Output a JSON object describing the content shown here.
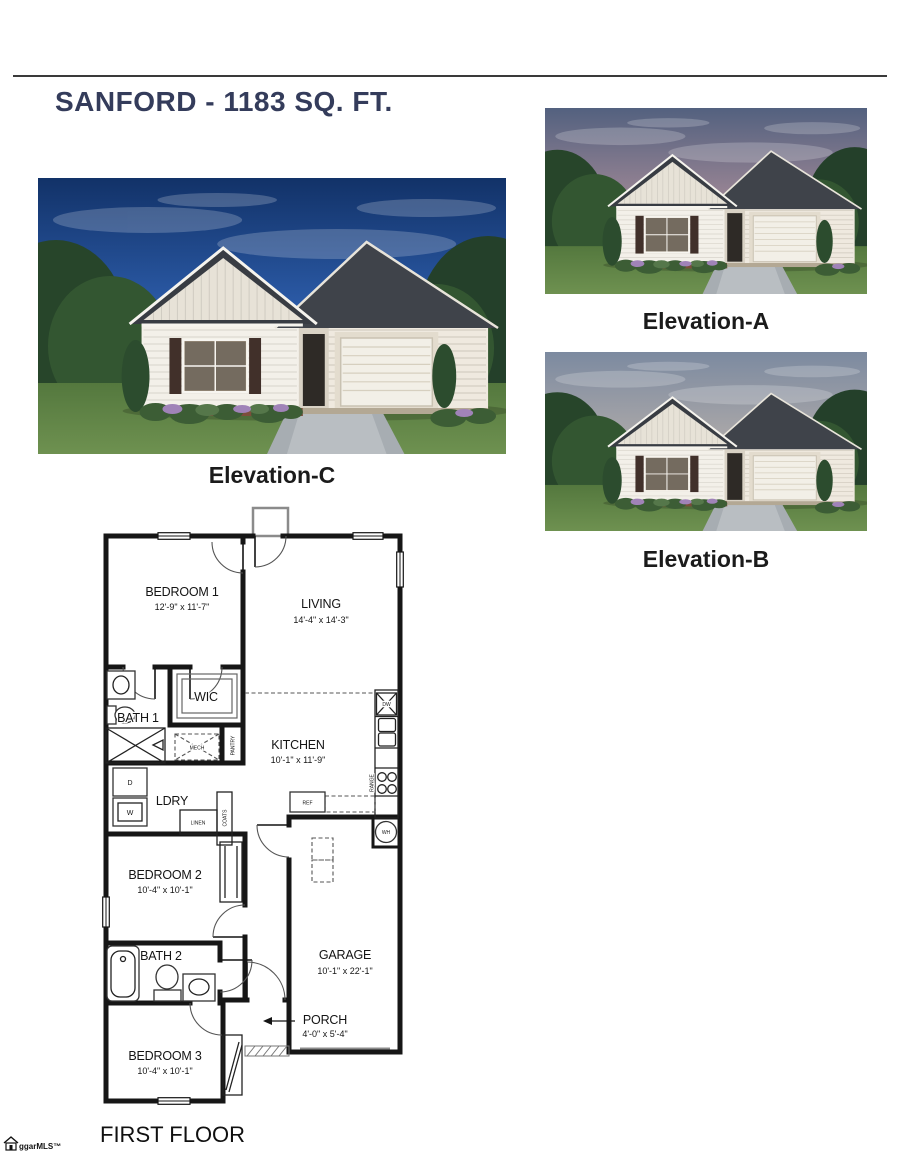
{
  "document": {
    "title": "SANFORD - 1183 SQ. FT.",
    "floor_label": "FIRST FLOOR",
    "watermark": "ggarMLS™"
  },
  "colors": {
    "title_navy": "#343c5b",
    "rule_dark": "#3a3a3a",
    "plan_ink": "#141414"
  },
  "elevations": [
    {
      "label": "Elevation-C",
      "sky": [
        "#123268",
        "#2b5aa6",
        "#9db7d8"
      ]
    },
    {
      "label": "Elevation-A",
      "sky": [
        "#53617f",
        "#968393",
        "#e5c7ae"
      ]
    },
    {
      "label": "Elevation-B",
      "sky": [
        "#7c8aa0",
        "#a8a6a8",
        "#d8c8b8"
      ]
    }
  ],
  "floor_plan": {
    "rooms": [
      {
        "name": "BEDROOM 1",
        "dims": "12'-9\" x 11'-7\""
      },
      {
        "name": "LIVING",
        "dims": "14'-4\" x 14'-3\""
      },
      {
        "name": "WIC"
      },
      {
        "name": "BATH 1"
      },
      {
        "name": "KITCHEN",
        "dims": "10'-1\" x 11'-9\""
      },
      {
        "name": "LDRY"
      },
      {
        "name": "BEDROOM 2",
        "dims": "10'-4\" x 10'-1\""
      },
      {
        "name": "GARAGE",
        "dims": "10'-1\" x 22'-1\""
      },
      {
        "name": "BATH 2"
      },
      {
        "name": "BEDROOM 3",
        "dims": "10'-4\" x 10'-1\""
      },
      {
        "name": "PORCH",
        "dims": "4'-0\" x 5'-4\""
      }
    ],
    "labels": {
      "ref": "REF",
      "wh": "WH",
      "dw": "DW",
      "range": "RANGE",
      "mech": "MECH",
      "pantry": "PANTRY",
      "linen": "LINEN",
      "coats": "COATS",
      "dryer": "D",
      "washer": "W"
    }
  }
}
